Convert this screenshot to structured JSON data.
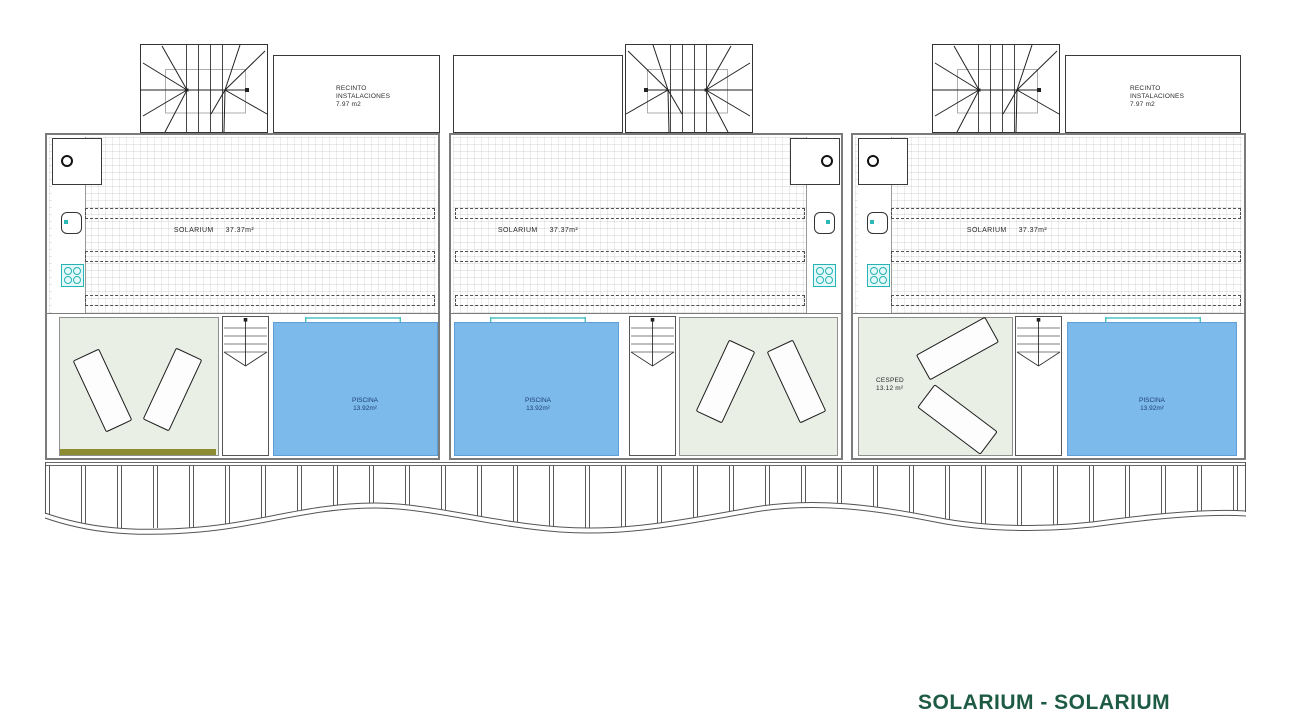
{
  "page_title": "SOLARIUM - SOLARIUM",
  "units": [
    {
      "name": "unit-1",
      "solarium_label": "SOLARIUM",
      "solarium_area": "37.37m²",
      "recinto_line1": "RECINTO",
      "recinto_line2": "INSTALACIONES",
      "recinto_area": "7.97 m2",
      "piscina_label": "PISCINA",
      "piscina_area": "13.92m²"
    },
    {
      "name": "unit-2",
      "solarium_label": "SOLARIUM",
      "solarium_area": "37.37m²",
      "piscina_label": "PISCINA",
      "piscina_area": "13.92m²"
    },
    {
      "name": "unit-3",
      "solarium_label": "SOLARIUM",
      "solarium_area": "37.37m²",
      "recinto_line1": "RECINTO",
      "recinto_line2": "INSTALACIONES",
      "recinto_area": "7.97 m2",
      "cesped_label": "CESPED",
      "cesped_area": "13.12 m²",
      "piscina_label": "PISCINA",
      "piscina_area": "13.92m²"
    }
  ],
  "colors": {
    "pool_blue": "#7cbaec",
    "lawn_green": "#e9efe4",
    "fixture_teal": "#2cb8b8",
    "olive_strip": "#8c8c33",
    "title_green": "#1e5b44"
  }
}
